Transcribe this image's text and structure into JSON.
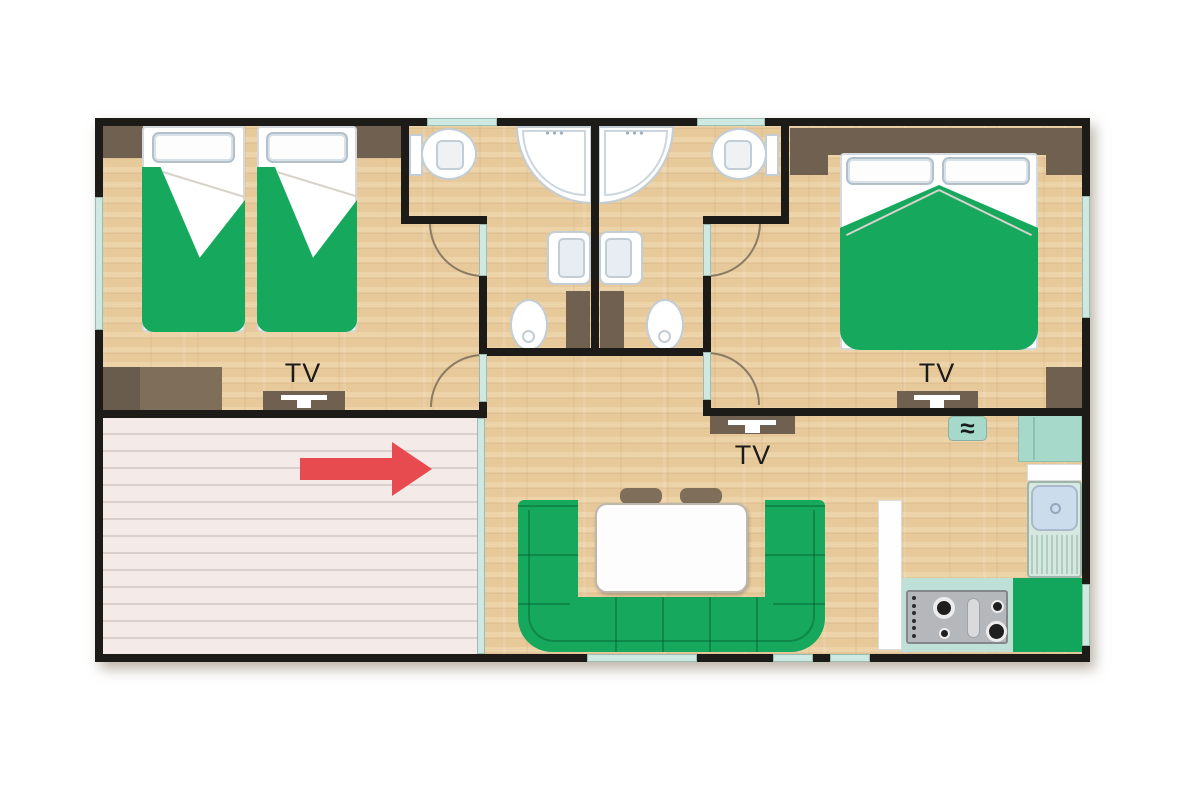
{
  "floorplan": {
    "labels": {
      "bedroom_left_tv": "TV",
      "bedroom_right_tv": "TV",
      "living_room_tv": "TV",
      "water_heater_symbol": "≈"
    },
    "colors": {
      "background": "#ffffff",
      "wall": "#1d1b18",
      "wood_floor": "#ecd0a2",
      "window_glass": "#cde9e2",
      "terrace_deck": "#f4ebe8",
      "terrace_line": "#dbcfcb",
      "furniture_green": "#16a85c",
      "furniture_brown": "#6f6050",
      "furniture_brown_light": "#7f6e59",
      "fixture_white": "#ffffff",
      "fixture_outline": "#c2cdd6",
      "arc_line": "#8b7a64",
      "arrow_red": "#e84b4f",
      "kitchen_teal": "#bfe0d6",
      "fridge_teal": "#a6d9c9",
      "sink_blue": "#cbdcec",
      "counter_green": "#12a55c",
      "cooktop_gray": "#b5b8ba"
    }
  }
}
